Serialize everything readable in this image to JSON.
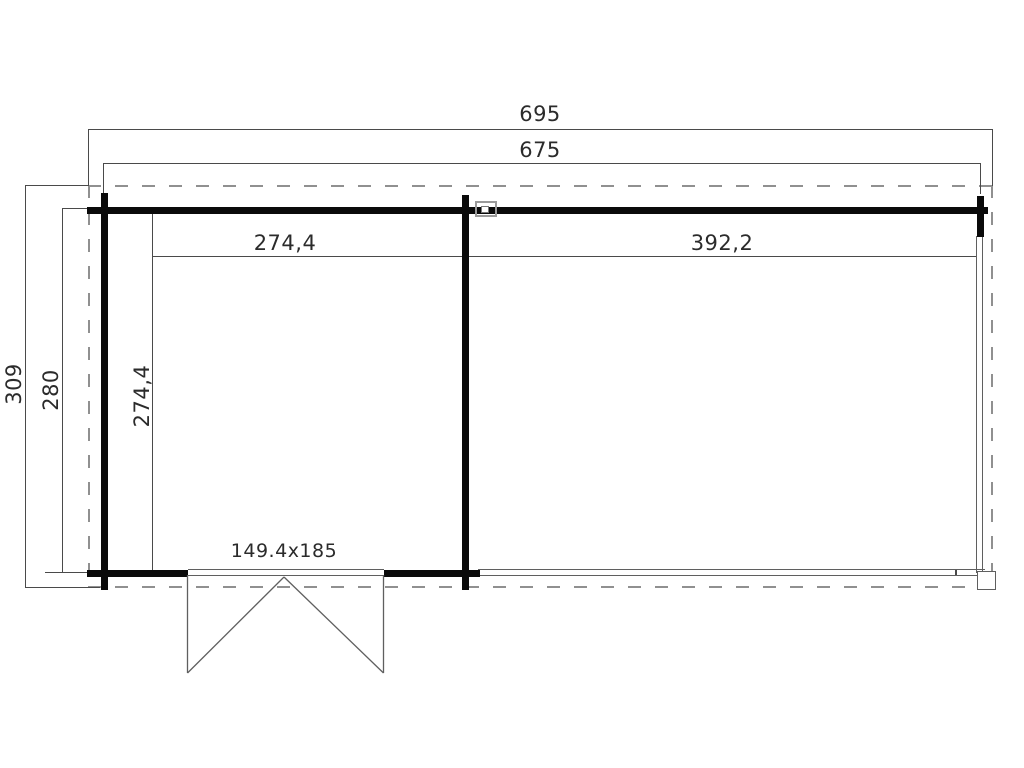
{
  "drawing_type": "floor-plan",
  "dimensions": {
    "overall_width": "695",
    "body_width": "675",
    "overall_depth": "309",
    "body_depth": "280",
    "room_left_width": "274,4",
    "room_left_depth": "274,4",
    "room_right_width": "392,2",
    "door_size": "149.4x185"
  },
  "colors": {
    "wall": "#0a0a0a",
    "thin_line": "#4a4a4a",
    "dashed_line": "#909090",
    "text": "#2b2b2b",
    "background": "#ffffff"
  }
}
